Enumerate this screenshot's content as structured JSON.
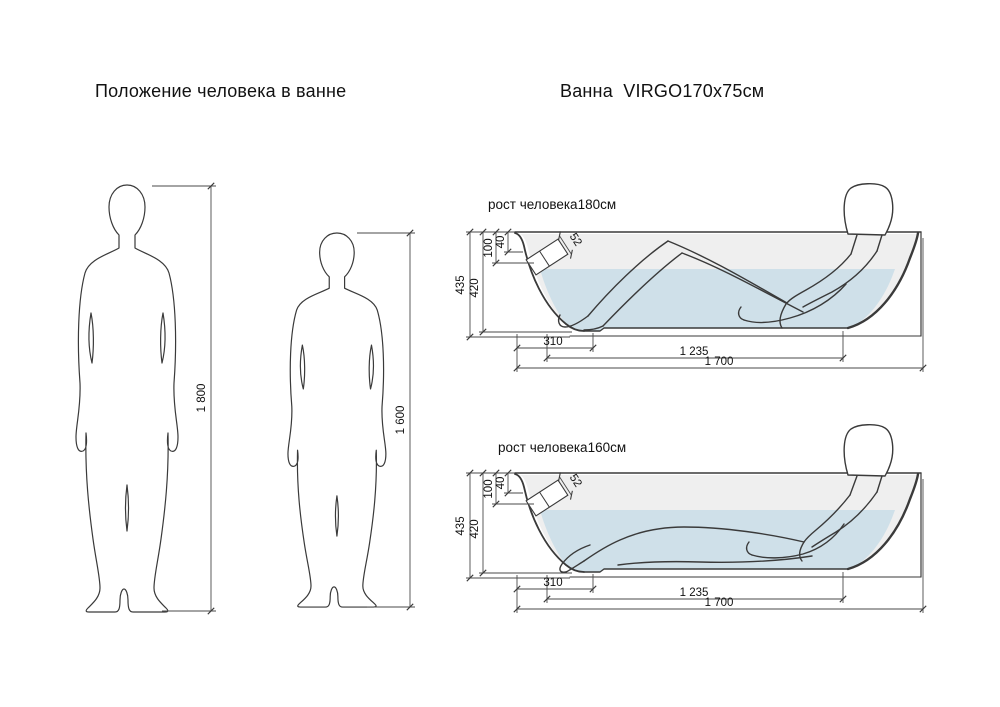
{
  "page": {
    "left_title": "Положение человека в ванне",
    "right_title": "Ванна  VIRGO170x75см"
  },
  "figures": {
    "tall": {
      "height_label": "1 800"
    },
    "short": {
      "height_label": "1 600"
    }
  },
  "baths": {
    "bath180": {
      "caption": "рост человека180см"
    },
    "bath160": {
      "caption": "рост человека160см"
    },
    "dims": {
      "total_depth": "435",
      "inner_depth": "420",
      "overflow_top": "100",
      "overflow_offset": "40",
      "overflow_size": "52",
      "foot_zone_length": "310",
      "inner_length": "1 235",
      "total_length": "1 700"
    },
    "colors": {
      "water": "#cfe0e9",
      "interior": "#efefef",
      "outline": "#3a3a3a"
    }
  }
}
